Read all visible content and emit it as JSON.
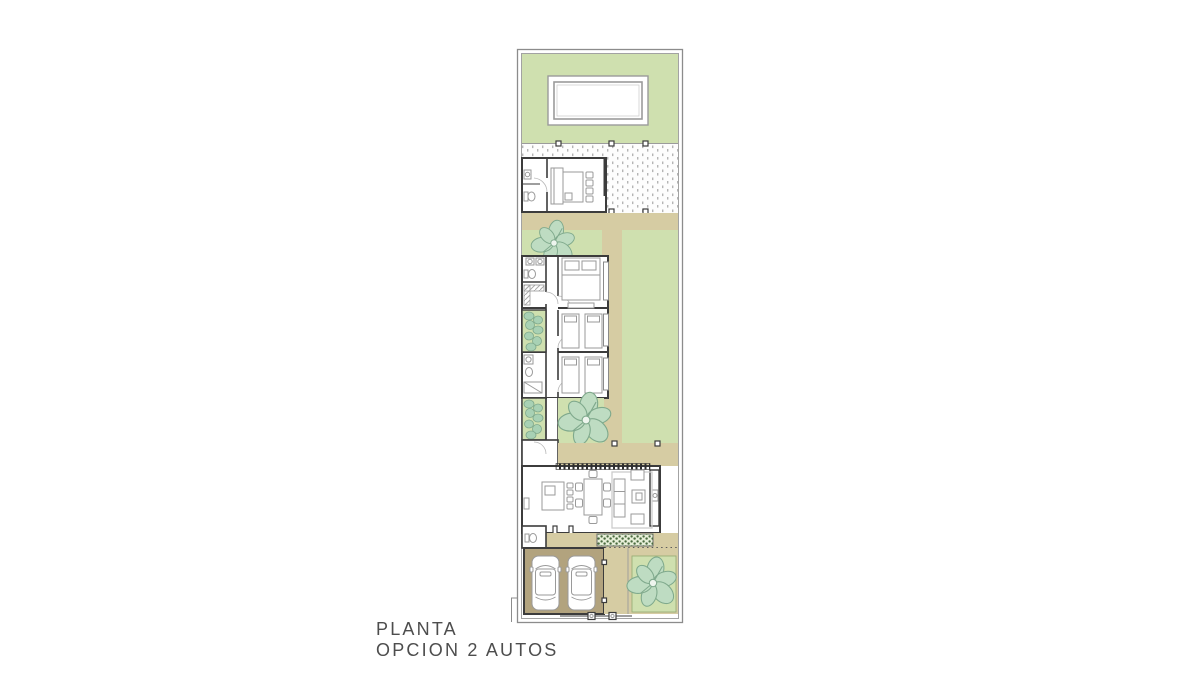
{
  "title": {
    "line1": "PLANTA",
    "line2": "OPCION 2 AUTOS"
  },
  "colors": {
    "background": "#ffffff",
    "garden": "#cfe0af",
    "path": "#d6cca3",
    "driveway": "#b2a37e",
    "wall": "#3c3c3c",
    "boundary": "#8c8c8c",
    "furniture": "#9a9a9a",
    "tree_fill": "#bedcc2",
    "tree_stroke": "#7fa98c",
    "shrub_fill": "#a8d1b4",
    "deck_dot": "#b5b5b5",
    "planter_hatch": "#4a6b3f",
    "label_text": "#4d4d4d"
  }
}
